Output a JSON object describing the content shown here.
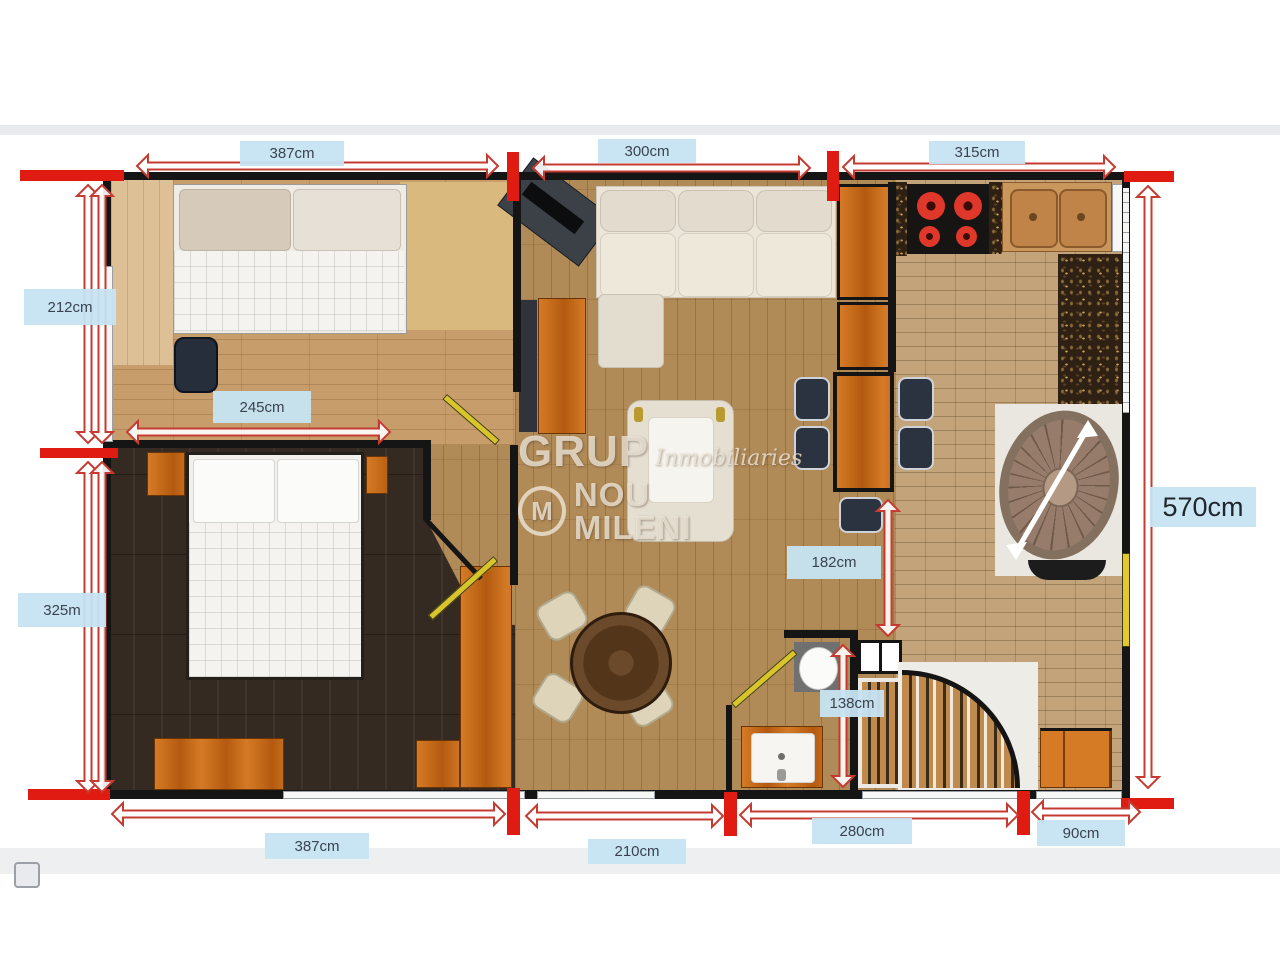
{
  "dimensions": {
    "top": [
      "387cm",
      "300cm",
      "315cm"
    ],
    "left": [
      "212cm",
      "325m"
    ],
    "inner": [
      "245cm",
      "182cm",
      "138cm"
    ],
    "right": [
      "570cm"
    ],
    "bottom": [
      "387cm",
      "210cm",
      "280cm",
      "90cm"
    ]
  },
  "watermark": {
    "word1": "GRUP",
    "word2": "Inmobiliaries",
    "word3": "NOU MILENI",
    "logo_letter": "M"
  },
  "colors": {
    "dimension_arrow": "#c63b31",
    "dimension_label_bg": "#cfe7f3",
    "wall": "#151515",
    "accent_orange": "#c9711c",
    "accent_red": "#e01b12"
  }
}
